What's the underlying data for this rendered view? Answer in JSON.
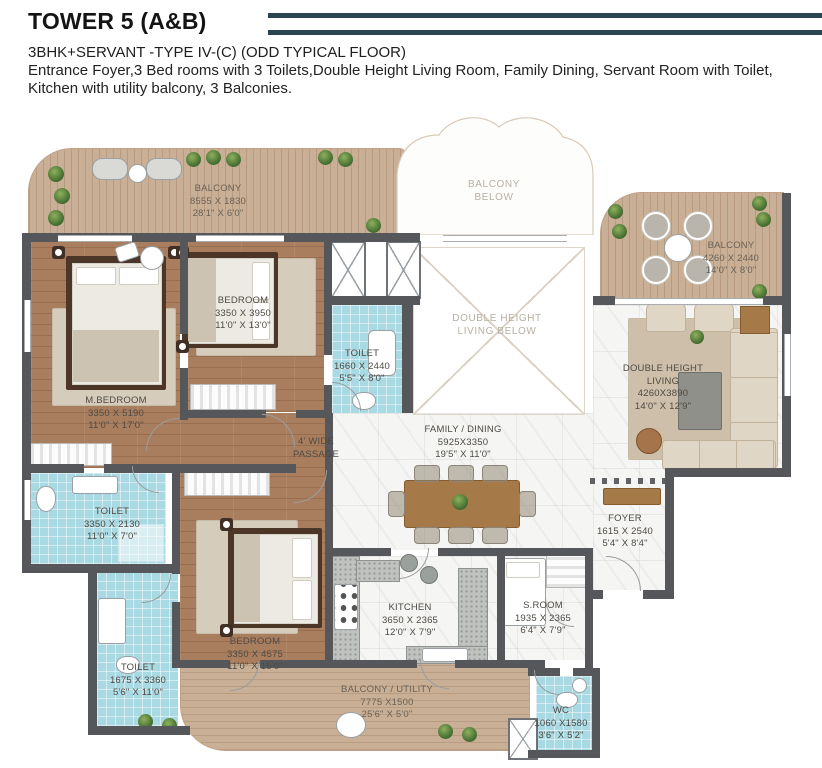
{
  "header": {
    "title": "TOWER 5 (A&B)",
    "subtitle": "3BHK+SERVANT -TYPE IV-(C) (ODD TYPICAL FLOOR)",
    "description_line1": "Entrance Foyer,3 Bed rooms with 3 Toilets,Double Height Living Room, Family Dining, Servant Room with Toilet,",
    "description_line2": "Kitchen with utility balcony, 3 Balconies.",
    "accent_color": "#2b4650"
  },
  "palette": {
    "wall": "#55575b",
    "deck": "#c9af96",
    "tile": "#a9d9e2",
    "wood": "#a97e5e",
    "marble": "#f5f5f3"
  },
  "plan": {
    "balcony_top": {
      "name": "BALCONY",
      "mm": "8555 X 1830",
      "ft": "28'1\" X 6'0\""
    },
    "balcony_below": {
      "line1": "BALCONY",
      "line2": "BELOW"
    },
    "balcony_right": {
      "name": "BALCONY",
      "mm": "4260 X 2440",
      "ft": "14'0\" X 8'0\""
    },
    "m_bedroom": {
      "name": "M.BEDROOM",
      "mm": "3350 X 5190",
      "ft": "11'0\" X 17'0\""
    },
    "bedroom_top": {
      "name": "BEDROOM",
      "mm": "3350 X 3950",
      "ft": "11'0\" X 13'0\""
    },
    "toilet_mid": {
      "name": "TOILET",
      "mm": "1660 X 2440",
      "ft": "5'5\" X 8'0\""
    },
    "passage": {
      "line1": "4' WIDE",
      "line2": "PASSAGE"
    },
    "family_dining": {
      "name": "FAMILY / DINING",
      "mm": "5925X3350",
      "ft": "19'5\" X 11'0\""
    },
    "dh_living_below": {
      "line1": "DOUBLE HEIGHT",
      "line2": "LIVING BELOW"
    },
    "dh_living": {
      "line1": "DOUBLE HEIGHT",
      "line2": "LIVING",
      "mm": "4260X3890",
      "ft": "14'0\" X 12'9\""
    },
    "foyer": {
      "name": "FOYER",
      "mm": "1615 X 2540",
      "ft": "5'4\" X 8'4\""
    },
    "toilet_left": {
      "name": "TOILET",
      "mm": "3350 X 2130",
      "ft": "11'0\" X 7'0\""
    },
    "toilet_bottom": {
      "name": "TOILET",
      "mm": "1675 X 3360",
      "ft": "5'6\" X 11'0\""
    },
    "bedroom_bottom": {
      "name": "BEDROOM",
      "mm": "3350 X 4575",
      "ft": "11'0\" X 15'0\""
    },
    "kitchen": {
      "name": "KITCHEN",
      "mm": "3650 X 2365",
      "ft": "12'0\" X 7'9\""
    },
    "s_room": {
      "name": "S.ROOM",
      "mm": "1935 X 2365",
      "ft": "6'4\" X 7'9\""
    },
    "balcony_utility": {
      "name": "BALCONY / UTILITY",
      "mm": "7775 X1500",
      "ft": "25'6\" X 5'0\""
    },
    "wc": {
      "name": "WC",
      "mm": "1060 X1580",
      "ft": "3'6\" X 5'2\""
    }
  }
}
